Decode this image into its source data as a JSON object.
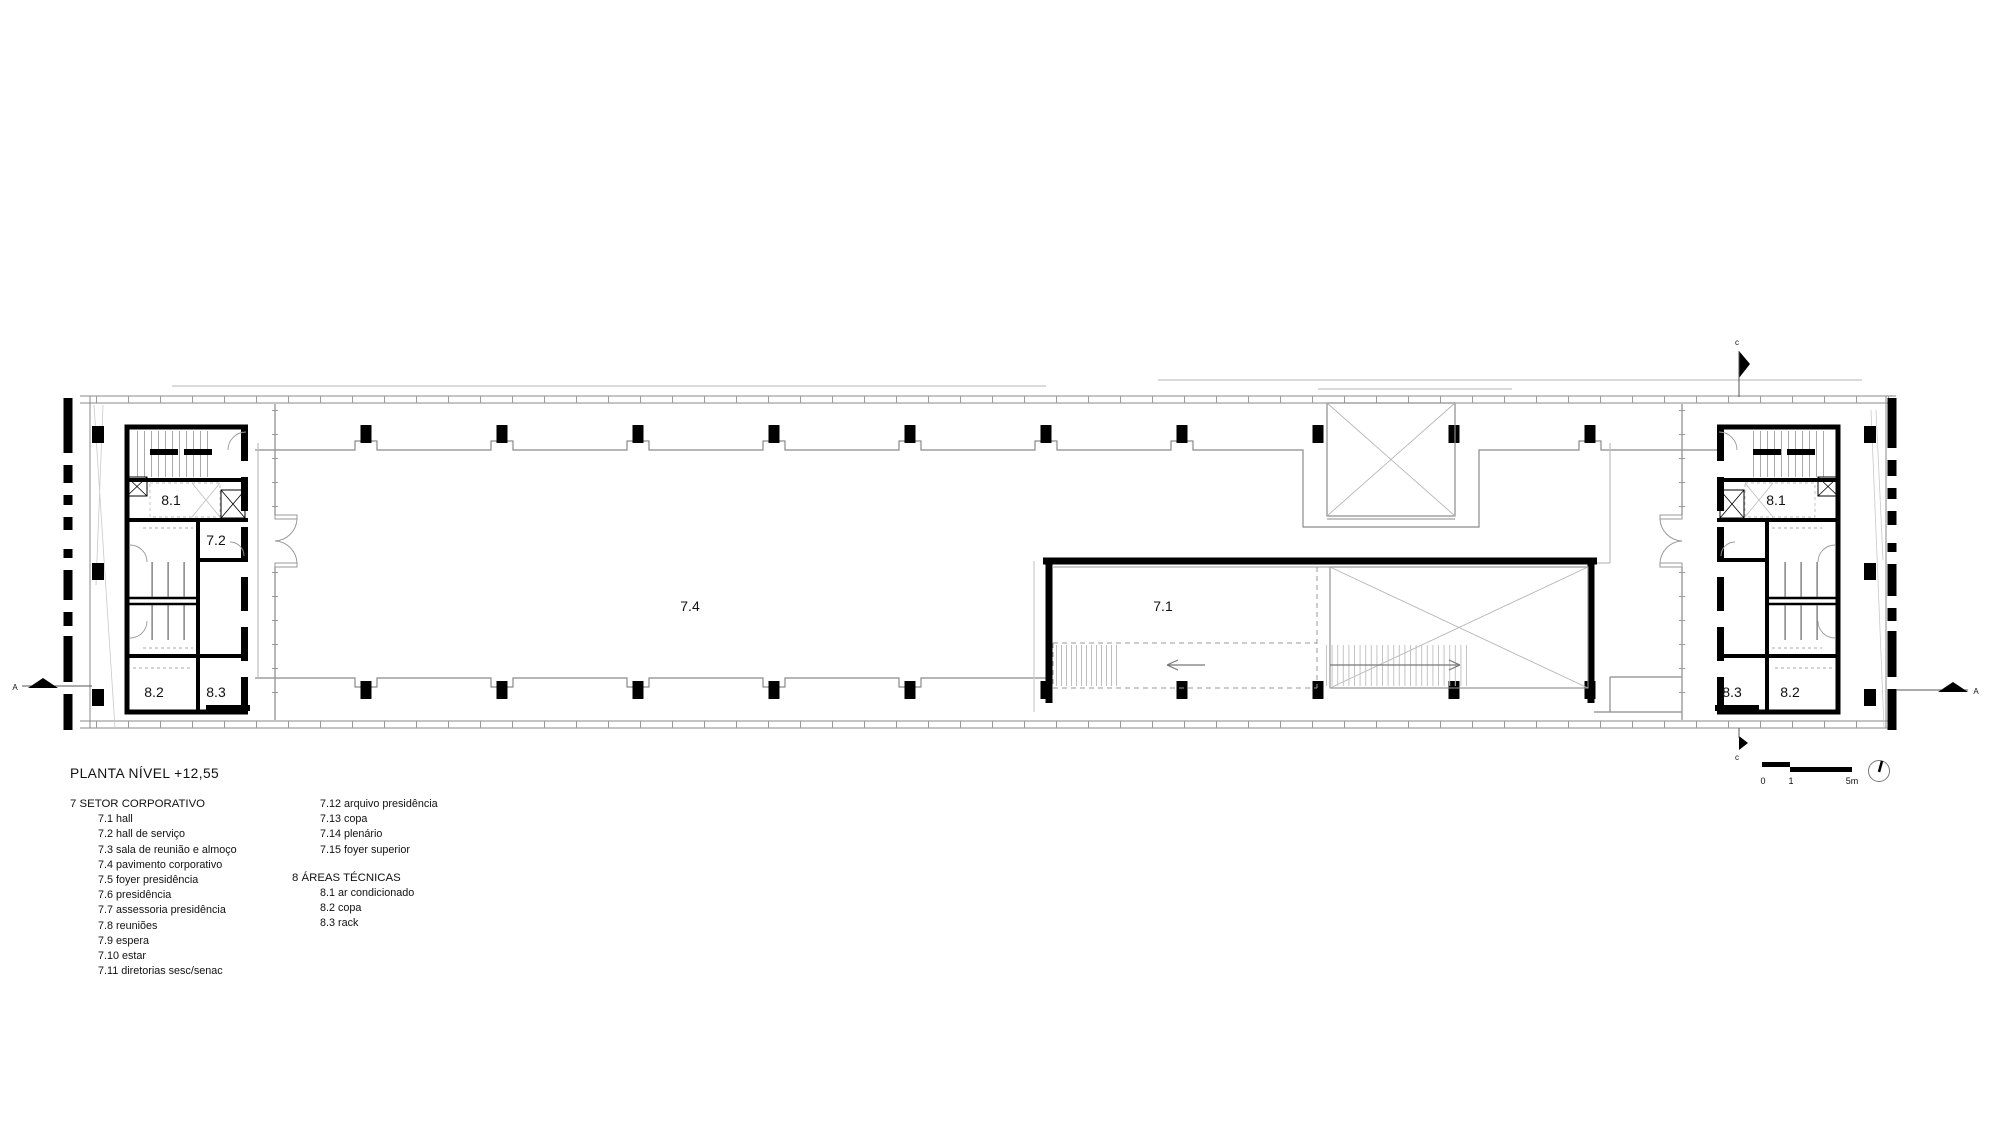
{
  "title": "PLANTA NÍVEL +12,55",
  "legend": {
    "group7_header": "7 SETOR CORPORATIVO",
    "group7_items": [
      "7.1 hall",
      "7.2 hall de serviço",
      "7.3 sala de reunião e almoço",
      "7.4 pavimento corporativo",
      "7.5 foyer presidência",
      "7.6 presidência",
      "7.7 assessoria presidência",
      "7.8 reuniões",
      "7.9 espera",
      "7.10 estar",
      "7.11 diretorias sesc/senac"
    ],
    "group7_items_col2": [
      "7.12 arquivo presidência",
      "7.13 copa",
      "7.14 plenário",
      "7.15 foyer superior"
    ],
    "group8_header": "8 ÁREAS TÉCNICAS",
    "group8_items": [
      "8.1 ar condicionado",
      "8.2 copa",
      "8.3 rack"
    ]
  },
  "plan": {
    "labels": {
      "left_core_ac": "8.1",
      "left_core_hall_servico": "7.2",
      "left_core_copa": "8.2",
      "left_core_rack": "8.3",
      "open_floor": "7.4",
      "hall": "7.1",
      "right_core_ac": "8.1",
      "right_core_rack": "8.3",
      "right_core_copa": "8.2"
    },
    "markers": {
      "section_a_left": "A",
      "section_a_right": "A",
      "section_c_top": "c",
      "section_c_bottom": "c"
    },
    "scale": {
      "zero": "0",
      "one": "1",
      "five_m": "5m"
    }
  },
  "colors": {
    "ink": "#000000",
    "line": "#8a8a8a",
    "light": "#bdbdbd",
    "bg": "#ffffff"
  }
}
